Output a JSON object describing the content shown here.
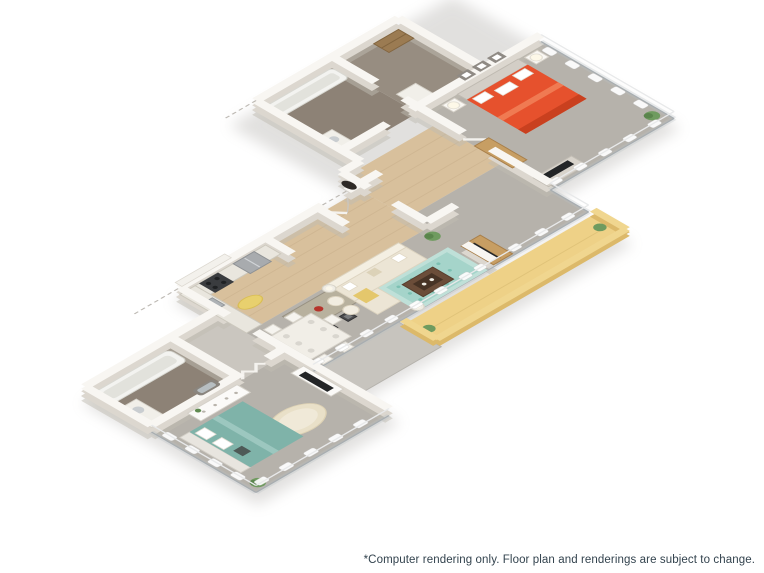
{
  "caption": {
    "text": "*Computer rendering only. Floor plan and renderings are subject to change."
  },
  "scene": {
    "type": "3d-isometric-cutaway-floor-plan-rendering",
    "bedrooms_shown": 2,
    "bathrooms_shown": 2,
    "balcony_shown": true,
    "palette": {
      "background": "#ffffff",
      "wall_top": "#f8f6f2",
      "wall_base": "#dcd7cf",
      "carpet": "#b6b2ab",
      "wood_floor": "#d8c09c",
      "bath_floor": "#8d8276",
      "balcony_floor": "#eed187",
      "balcony_parapet": "#dcb96a",
      "master_bed": "#e6512d",
      "guest_bed": "#7fb3a9",
      "area_rug_teal": "#aed9d0",
      "sofa_cream": "#ece5d5",
      "accent_throw_yellow": "#e4c76c",
      "wood_furniture": "#c79e63",
      "tv_screen": "#232527",
      "caption_text": "#33434e"
    },
    "rooms": [
      {
        "id": "master-bedroom",
        "floor": "carpet",
        "furniture": [
          "orange-bed",
          "two-nightstands",
          "two-lamps",
          "three-wall-frames",
          "tv-console",
          "tv",
          "plant"
        ]
      },
      {
        "id": "master-bathroom",
        "floor": "dark-tile",
        "furniture": [
          "bathtub",
          "vanity",
          "linen-shelves"
        ]
      },
      {
        "id": "kitchen",
        "floor": "wood",
        "furniture": [
          "refrigerator",
          "range",
          "sink",
          "counters",
          "island",
          "two-barstools",
          "yellow-rug"
        ]
      },
      {
        "id": "entry-hall",
        "floor": "wood",
        "furniture": [
          "entry-door",
          "closet",
          "oval-mirror"
        ]
      },
      {
        "id": "living-room",
        "floor": "carpet",
        "furniture": [
          "sectional-sofa",
          "teal-area-rug",
          "coffee-table",
          "floor-lamps",
          "media-console",
          "tv",
          "poufs",
          "plants"
        ]
      },
      {
        "id": "dining-area",
        "floor": "carpet",
        "furniture": [
          "dining-table",
          "six-chairs",
          "place-settings"
        ]
      },
      {
        "id": "balcony",
        "floor": "tan-deck",
        "furniture": [
          "parapet-wall",
          "plant"
        ]
      },
      {
        "id": "guest-bedroom",
        "floor": "carpet",
        "furniture": [
          "teal-bed",
          "dresser",
          "wall-mirror",
          "shag-rug",
          "tv-console",
          "tv",
          "curtains"
        ]
      },
      {
        "id": "guest-bathroom",
        "floor": "dark-tile",
        "furniture": [
          "bathtub",
          "vanity"
        ]
      }
    ]
  }
}
